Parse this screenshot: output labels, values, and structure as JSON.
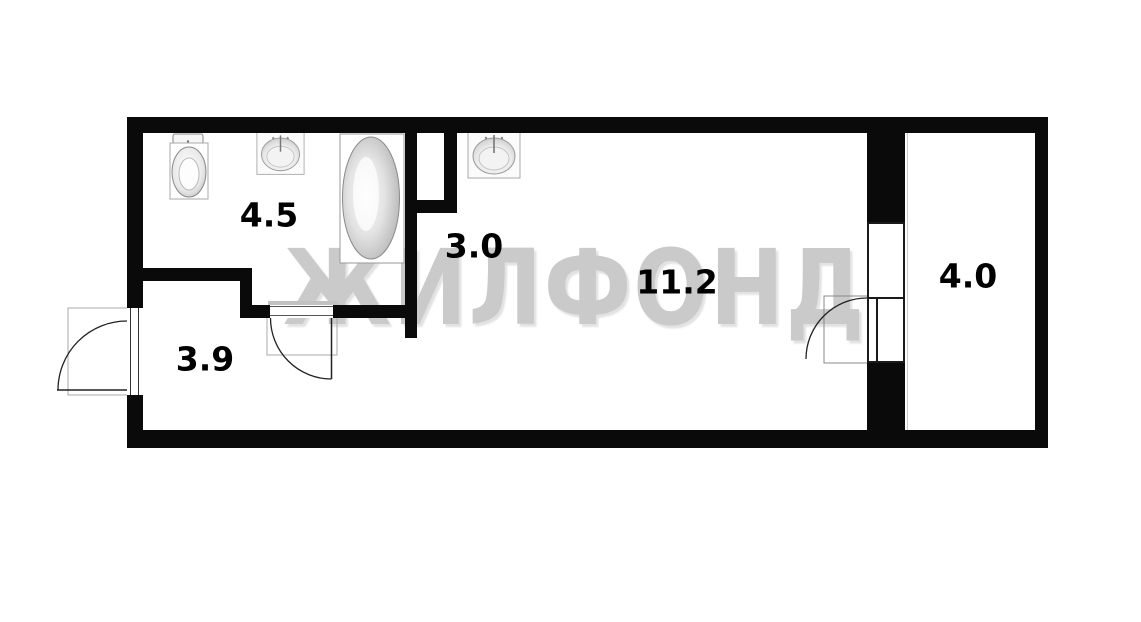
{
  "watermark_text": "ЖИЛФОНД",
  "rooms": [
    {
      "id": "bathroom",
      "area_label": "4.5"
    },
    {
      "id": "corridor",
      "area_label": "3.0"
    },
    {
      "id": "hallway",
      "area_label": "3.9"
    },
    {
      "id": "living-room",
      "area_label": "11.2"
    },
    {
      "id": "balcony",
      "area_label": "4.0"
    }
  ],
  "fixtures": [
    {
      "icon": "toilet-icon",
      "room": "bathroom"
    },
    {
      "icon": "sink-icon",
      "room": "bathroom"
    },
    {
      "icon": "bathtub-icon",
      "room": "bathroom"
    },
    {
      "icon": "sink-icon",
      "room": "corridor"
    }
  ],
  "doors": [
    {
      "icon": "door-swing-icon",
      "location": "entry-left-wall"
    },
    {
      "icon": "door-swing-icon",
      "location": "bathroom-wall"
    },
    {
      "icon": "door-swing-icon",
      "location": "balcony-wall"
    }
  ],
  "colors": {
    "wall": "#0a0a0a",
    "watermark": "#cacaca",
    "room_label": "#000000",
    "background": "#ffffff"
  }
}
